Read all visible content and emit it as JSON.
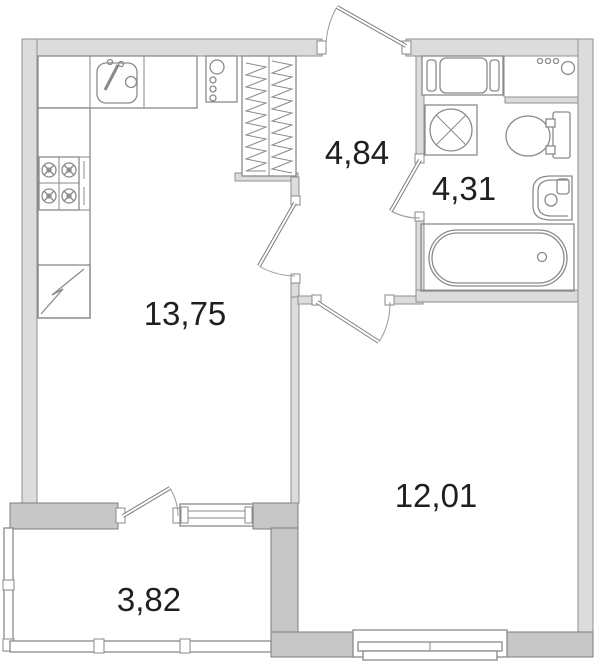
{
  "floor_plan": {
    "type": "apartment-floor-plan",
    "rooms": [
      {
        "id": "kitchen-living-room",
        "area_label": "13,75"
      },
      {
        "id": "hallway",
        "area_label": "4,84"
      },
      {
        "id": "bathroom",
        "area_label": "4,31"
      },
      {
        "id": "bedroom",
        "area_label": "12,01"
      },
      {
        "id": "balcony",
        "area_label": "3,82"
      }
    ],
    "colors": {
      "wall_light": "#dcdcdc",
      "wall_dark": "#c7c7c7",
      "outline": "#8a8a8a",
      "background": "#ffffff",
      "label_text": "#1f1f1f"
    },
    "fixture_icons": [
      "kitchen-sink-icon",
      "stove-icon",
      "fridge-icon",
      "boiler-icon",
      "wardrobe-icon",
      "washing-machine-icon",
      "bathroom-cabinet-icon",
      "bathroom-counter-icon",
      "toilet-icon",
      "bathroom-sink-icon",
      "bathtub-icon",
      "entrance-door-icon",
      "interior-door-icon",
      "balcony-door-icon",
      "window-icon"
    ]
  }
}
